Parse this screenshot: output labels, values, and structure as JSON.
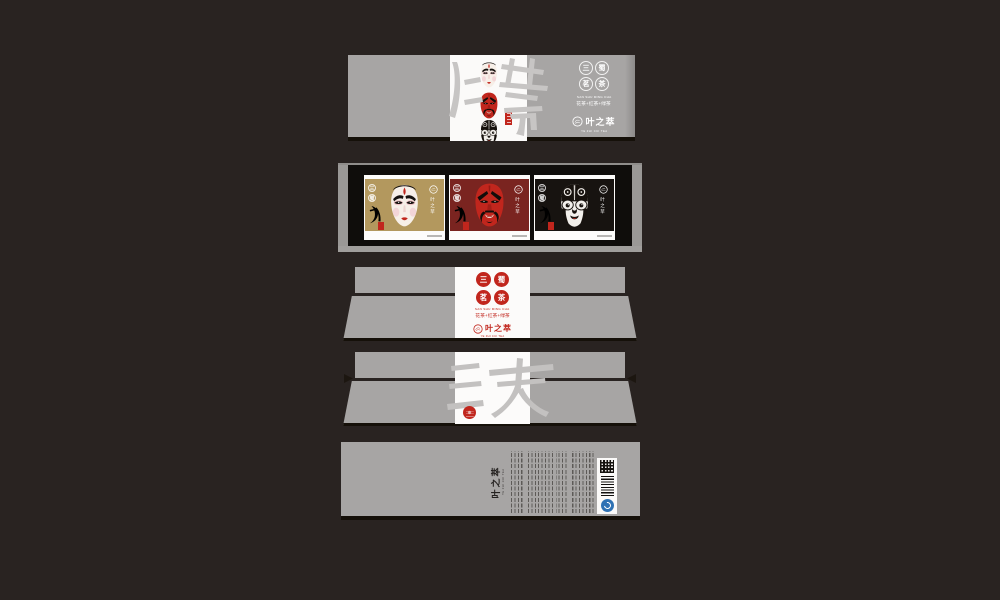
{
  "canvas": {
    "background": "#292321"
  },
  "colors": {
    "seal_red": "#c1261d",
    "panel_gray": "#a7a5a4",
    "gold": "#b3985e",
    "dark_red": "#7a2420",
    "card_black": "#171310",
    "qs_blue": "#2f72b4"
  },
  "brand": {
    "name": "叶之萃",
    "latin": "YE ZHI CUI TEA"
  },
  "product": {
    "name": "三蜀茗茶",
    "pinyin": "SAN SHU MING CHA",
    "tagline": "花茶+红茶+绿茶",
    "seal_chars": [
      "三",
      "蜀",
      "茗",
      "茶"
    ]
  },
  "virtues": [
    "仁",
    "義",
    "勇"
  ],
  "watermarks": {
    "lid_top": "仁義勇",
    "box_front": "三英"
  },
  "tray": {
    "cards": [
      {
        "virtue": "仁",
        "mask": "white-face-mask"
      },
      {
        "virtue": "義",
        "mask": "red-face-mask"
      },
      {
        "virtue": "勇",
        "mask": "black-face-mask"
      }
    ]
  }
}
